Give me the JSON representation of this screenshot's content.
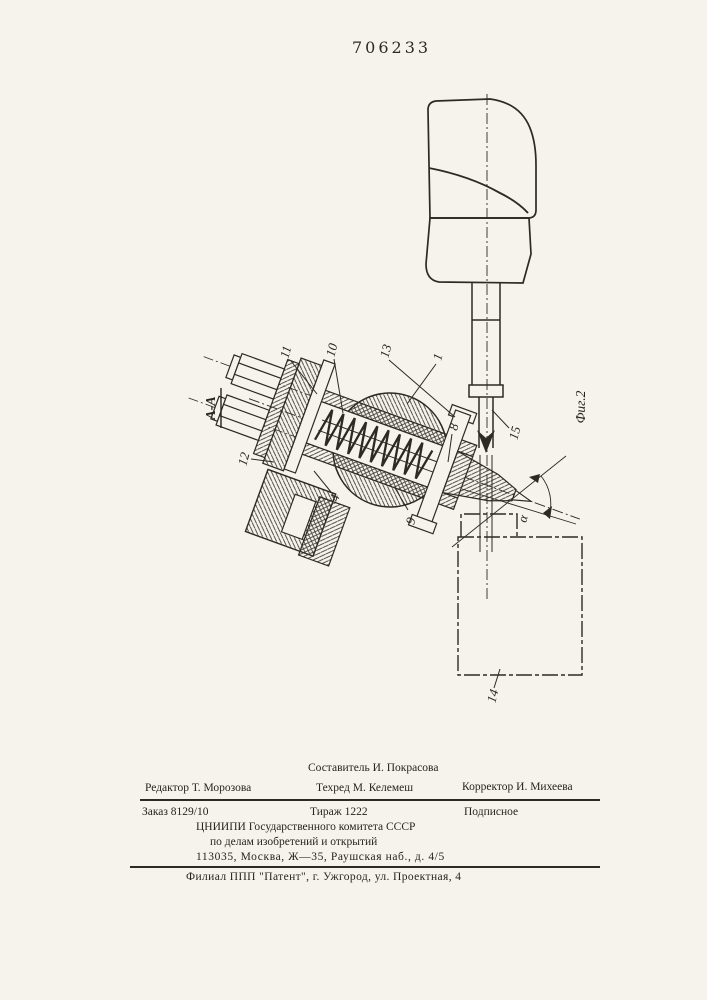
{
  "page": {
    "patent_number": "706233"
  },
  "figure": {
    "figure_label": "Фиг.2",
    "section_label": "А-А",
    "angle_label": "α",
    "part_labels": [
      "11",
      "10",
      "13",
      "1",
      "8",
      "15",
      "12",
      "4",
      "9",
      "14"
    ]
  },
  "colophon": {
    "compositor": "Составитель И. Покрасова",
    "editor": "Редактор Т. Морозова",
    "techred": "Техред М. Келемеш",
    "corrector": "Корректор И. Михеева",
    "order": "Заказ 8129/10",
    "print_run": "Тираж 1222",
    "subscription": "Подписное",
    "org_line1": "ЦНИИПИ Государственного комитета СССР",
    "org_line2": "по делам изобретений и открытий",
    "org_address": "113035, Москва, Ж—35, Раушская наб., д. 4/5",
    "branch_line": "Филиал ППП \"Патент\", г. Ужгород, ул. Проектная, 4"
  }
}
